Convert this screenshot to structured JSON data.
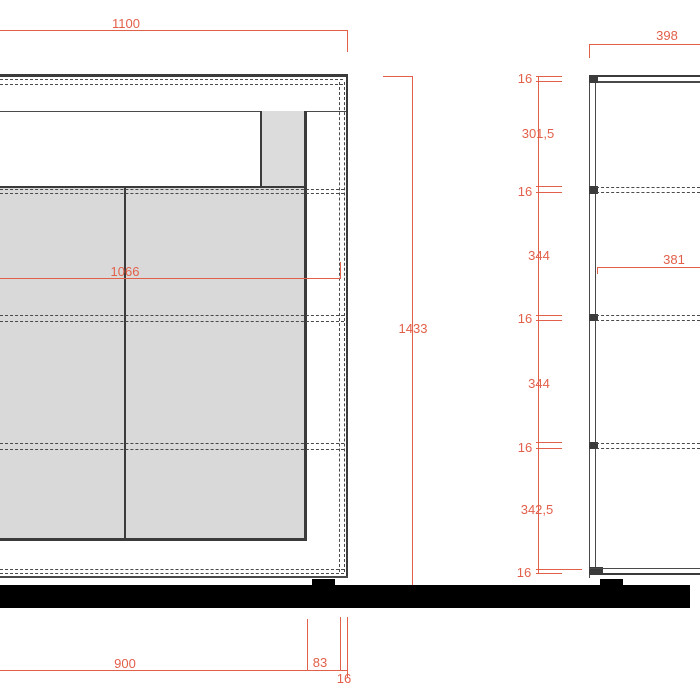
{
  "front_view": {
    "width": "1100",
    "inner_width": "1066",
    "height": "1433",
    "plinth_width": "900",
    "plinth_offset": "83",
    "side_thickness": "16"
  },
  "side_view": {
    "depth": "398",
    "inner_depth": "381",
    "heights": [
      "16",
      "301,5",
      "16",
      "344",
      "16",
      "344",
      "16",
      "342,5",
      "16"
    ]
  },
  "colors": {
    "dimension": "#e2604a",
    "outline": "#3b3b3b",
    "hidden_line": "#4a4a4a",
    "panel_fill": "#d9d9d9",
    "plinth_fill": "#000000"
  }
}
